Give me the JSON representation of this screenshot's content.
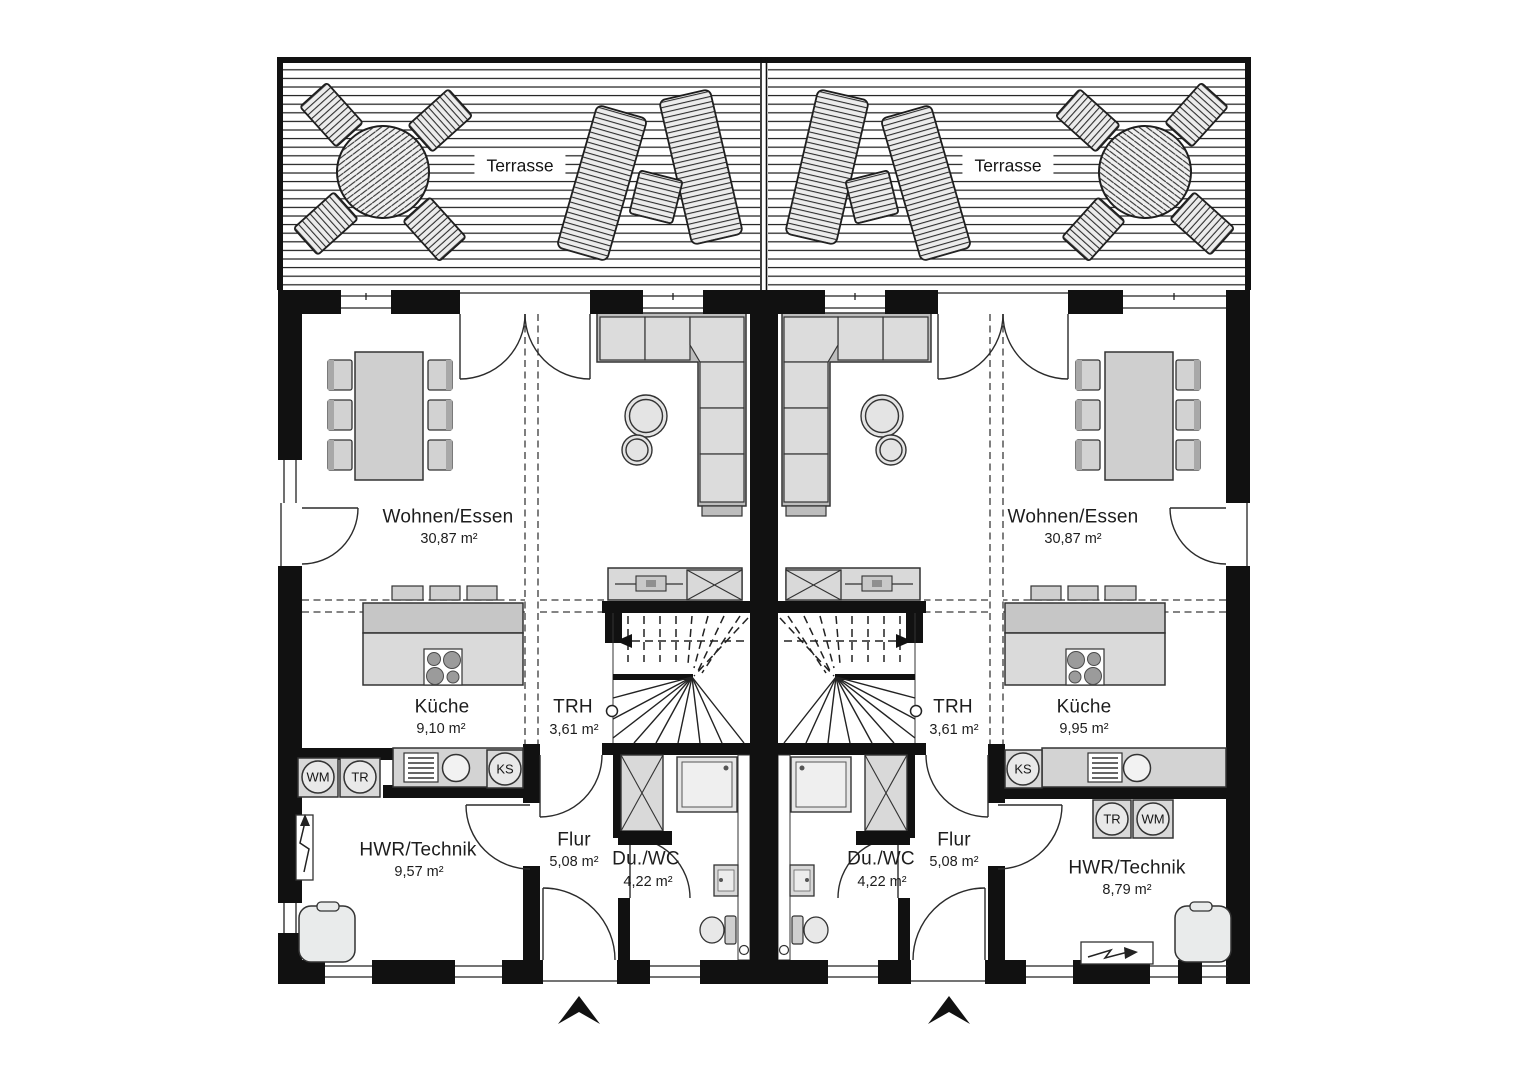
{
  "terrace": {
    "label": "Terrasse"
  },
  "units": [
    {
      "side": "left",
      "rooms": [
        {
          "name": "Wohnen/Essen",
          "area": "30,87 m²"
        },
        {
          "name": "Küche",
          "area": "9,10 m²"
        },
        {
          "name": "TRH",
          "area": "3,61 m²"
        },
        {
          "name": "Flur",
          "area": "5,08 m²"
        },
        {
          "name": "Du./WC",
          "area": "4,22 m²"
        },
        {
          "name": "HWR/Technik",
          "area": "9,57 m²"
        }
      ],
      "appliances": [
        {
          "label": "WM"
        },
        {
          "label": "TR"
        },
        {
          "label": "KS"
        }
      ]
    },
    {
      "side": "right",
      "rooms": [
        {
          "name": "Wohnen/Essen",
          "area": "30,87 m²"
        },
        {
          "name": "Küche",
          "area": "9,95 m²"
        },
        {
          "name": "TRH",
          "area": "3,61 m²"
        },
        {
          "name": "Flur",
          "area": "5,08 m²"
        },
        {
          "name": "Du./WC",
          "area": "4,22 m²"
        },
        {
          "name": "HWR/Technik",
          "area": "8,79 m²"
        }
      ],
      "appliances": [
        {
          "label": "KS"
        },
        {
          "label": "TR"
        },
        {
          "label": "WM"
        }
      ]
    }
  ],
  "colors": {
    "wall": "#0f0f0f",
    "line": "#2b2b2b",
    "furniture": "#d8d8d8",
    "furniture_dark": "#bdbdbd",
    "floor": "#ffffff"
  }
}
